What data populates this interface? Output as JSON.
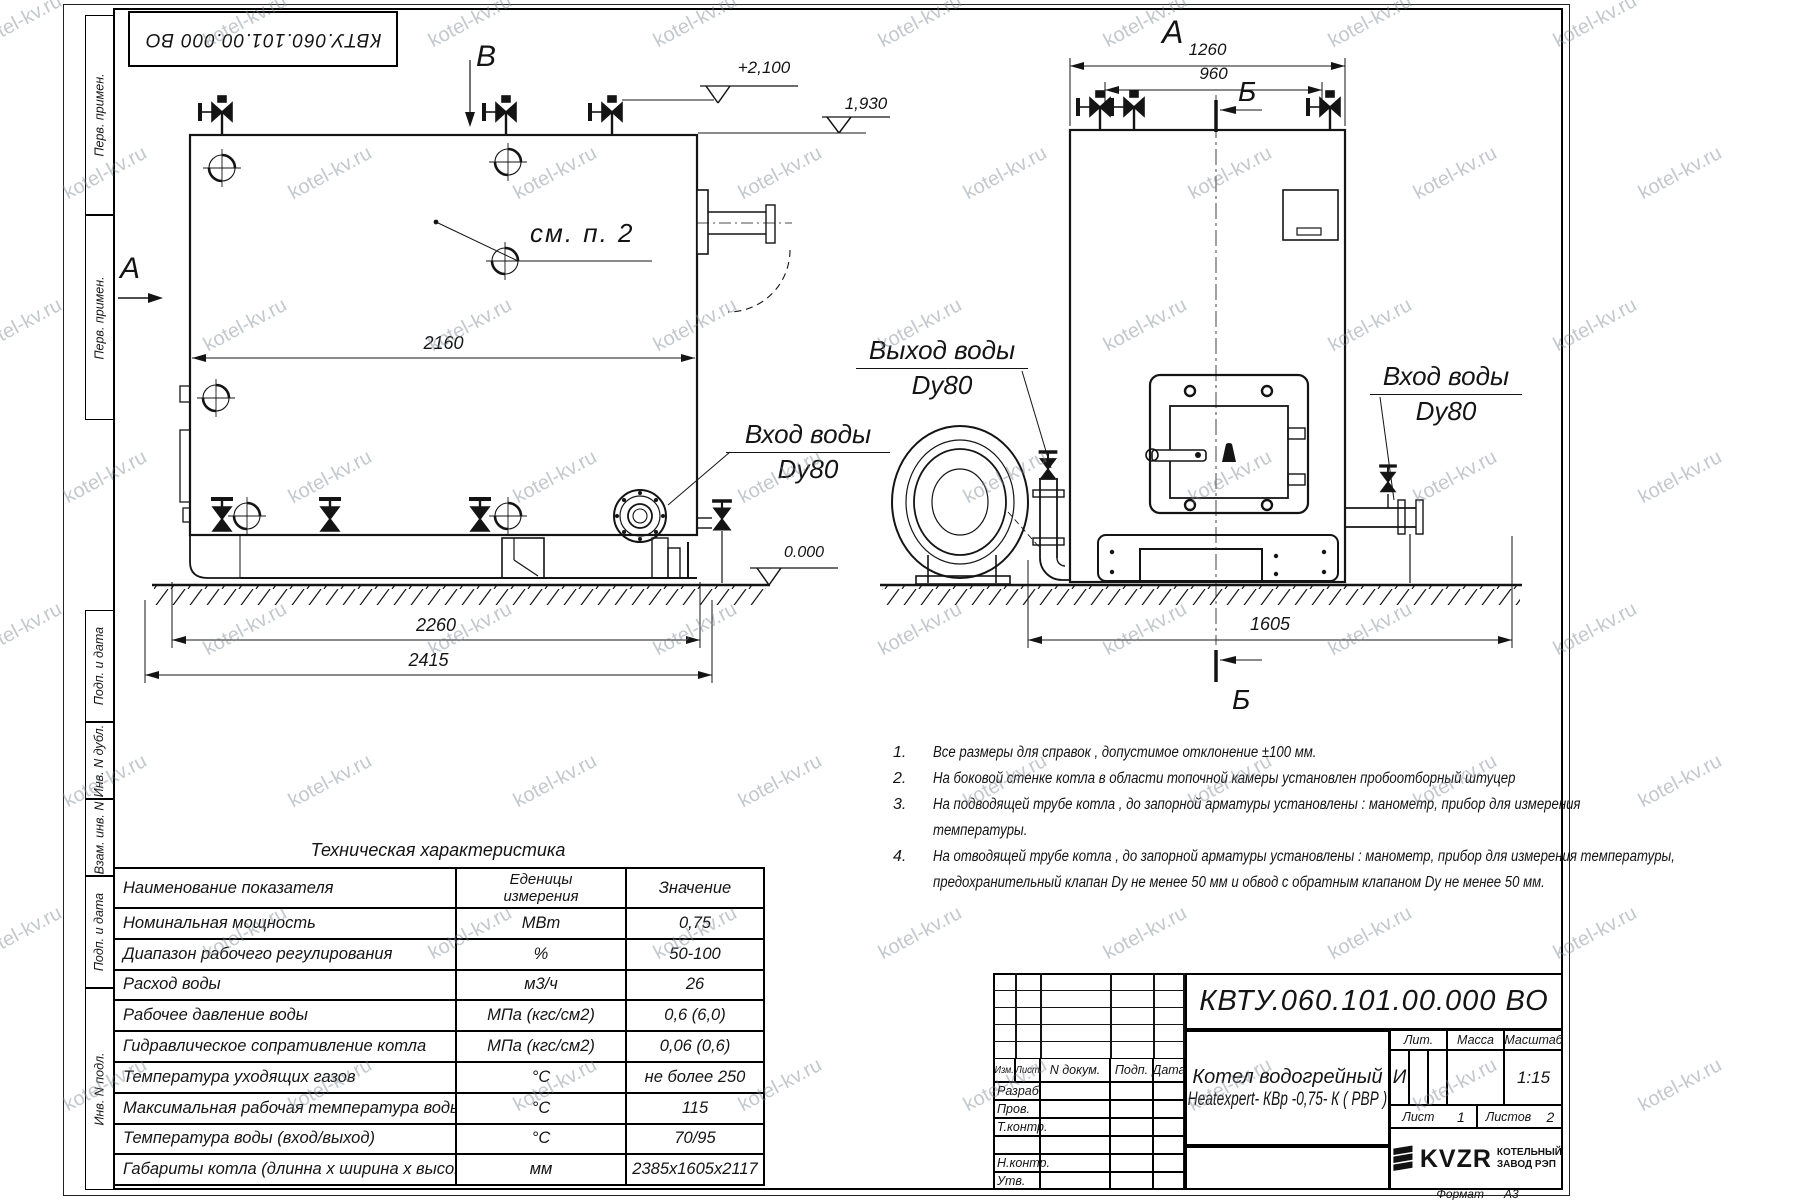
{
  "watermark": {
    "text": "kotel-kv.ru"
  },
  "stamp_top": {
    "doc_number": "КВТУ.060.101.00.000  ВО"
  },
  "sidebar": {
    "top": [
      "Перв. примен.",
      "Перв. примен."
    ],
    "bottom": [
      "Подп. и дата",
      "Инв. N дубл.",
      "Взам. инв. N",
      "Подп. и дата",
      "Инв. N подл."
    ]
  },
  "labels": {
    "lv": {
      "section_b": "В",
      "section_a": "А",
      "elev_top": "+2,100",
      "elev_mid": "1,930",
      "elev_zero": "0.000",
      "see_note": "см. п. 2",
      "dim_2160": "2160",
      "dim_2260": "2260",
      "dim_2415": "2415",
      "inlet_line1": "Вход воды",
      "inlet_line2": "Dy80"
    },
    "rv": {
      "view_a": "А",
      "sec_b_top": "Б",
      "sec_b_bottom": "Б",
      "dim_1260": "1260",
      "dim_960": "960",
      "dim_1605": "1605",
      "outlet_line1": "Выход воды",
      "outlet_line2": "Dy80",
      "inlet_line1": "Вход воды",
      "inlet_line2": "Dy80"
    }
  },
  "notes": [
    {
      "num": "1.",
      "text": "Все размеры для справок , допустимое отклонение  ±100 мм."
    },
    {
      "num": "2.",
      "text": "На боковой стенке котла в области топочной камеры установлен пробоотборный штуцер"
    },
    {
      "num": "3.",
      "text": "На   подводящей трубе котла , до запорной арматуры установлены :  манометр,  прибор для измерения"
    },
    {
      "num": "",
      "text": "температуры."
    },
    {
      "num": "4.",
      "text": "На отводящей трубе котла , до запорной арматуры установлены :  манометр,  прибор для измерения температуры,"
    },
    {
      "num": "",
      "text": "предохранительный клапан  Dу не менее  50 мм и обвод с обратным клапаном  Dу не менее  50 мм."
    }
  ],
  "table": {
    "title": "Техническая характеристика",
    "headers": {
      "name": "Наименование показателя",
      "units_1": "Еденицы",
      "units_2": "измерения",
      "value": "Значение"
    },
    "rows": [
      [
        "Номинальная мощность",
        "МВт",
        "0,75"
      ],
      [
        "Диапазон рабочего регулирования",
        "%",
        "50-100"
      ],
      [
        "Расход воды",
        "м3/ч",
        "26"
      ],
      [
        "Рабочее давление воды",
        "МПа (кгс/см2)",
        "0,6 (6,0)"
      ],
      [
        "Гидравлическое сопративление котла",
        "МПа (кгс/см2)",
        "0,06 (0,6)"
      ],
      [
        "Температура уходящих газов",
        "°С",
        "не более 250"
      ],
      [
        "Максимальная рабочая температура воды",
        "°С",
        "115"
      ],
      [
        "Температура воды (вход/выход)",
        "°С",
        "70/95"
      ],
      [
        "Габариты котла (длинна х ширина х высота)",
        "мм",
        "2385х1605х2117"
      ]
    ]
  },
  "titleblock": {
    "doc_number": "КВТУ.060.101.00.000  ВО",
    "header_cols": [
      "Изм.",
      "Лист",
      "N докум.",
      "Подп.",
      "Дата"
    ],
    "sig_rows": [
      "Разраб.",
      "Пров.",
      "Т.контр.",
      "",
      "Н.контр.",
      "Утв."
    ],
    "product_line1": "Котел водогрейный",
    "product_line2": "Heatexpert- КВр -0,75- К ( РВР )",
    "lit_label": "Лит.",
    "mass_label": "Масса",
    "scale_label": "Масштаб",
    "lit_value": "И",
    "scale_value": "1:15",
    "sheet_label": "Лист",
    "sheet_value": "1",
    "sheets_label": "Листов",
    "sheets_value": "2",
    "logo_text": "KVZR",
    "logo_line1": "КОТЕЛЬНЫЙ",
    "logo_line2": "ЗАВОД РЭП",
    "format_label": "Формат",
    "format_value": "А3"
  }
}
